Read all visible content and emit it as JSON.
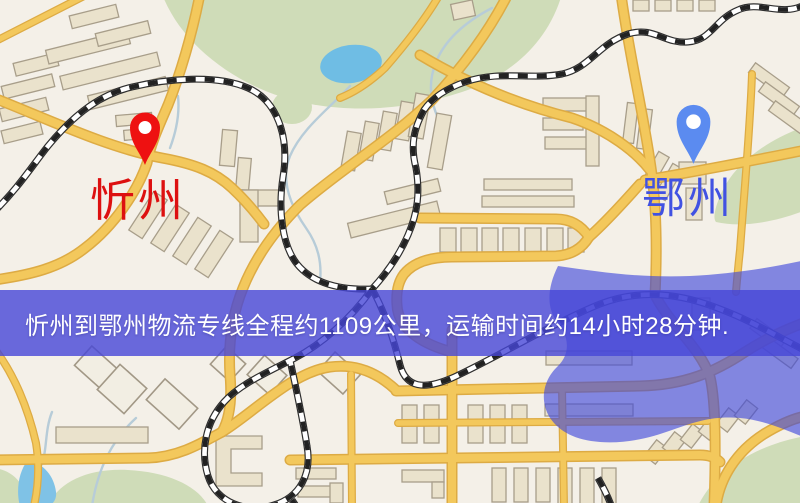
{
  "page": {
    "width": 800,
    "height": 503,
    "kind": "logistics-route-map-screenshot"
  },
  "banner": {
    "text": "忻州到鄂州物流专线全程约1109公里，运输时间约14小时28分钟.",
    "background_color": "#4646d7",
    "text_color": "#ffffff"
  },
  "route_info": {
    "origin": "忻州",
    "destination": "鄂州",
    "service": "物流专线",
    "distance_text": "全程约1109公里",
    "distance_km": 1109,
    "duration_text": "运输时间约14小时28分钟",
    "duration_hours": 14,
    "duration_minutes": 28
  },
  "markers": {
    "origin": {
      "label": "忻州",
      "pin_color": "#ee1111",
      "label_color": "#dd1010",
      "pin_style": "red-droplet-pin"
    },
    "destination": {
      "label": "鄂州",
      "pin_color": "#5b8bf0",
      "label_color": "#4152e2",
      "pin_style": "blue-droplet-pin"
    }
  },
  "map_style": {
    "background_color": "#f4f0e8",
    "road_color": "#f3c85c",
    "road_casing_color": "#ddab44",
    "building_color": "#eae2cc",
    "park_color": "#cfdcb8",
    "water_color": "#6fbde4",
    "railway_colors": "black-white-dashed",
    "highlight_overlay_color": "#3c46dc"
  }
}
